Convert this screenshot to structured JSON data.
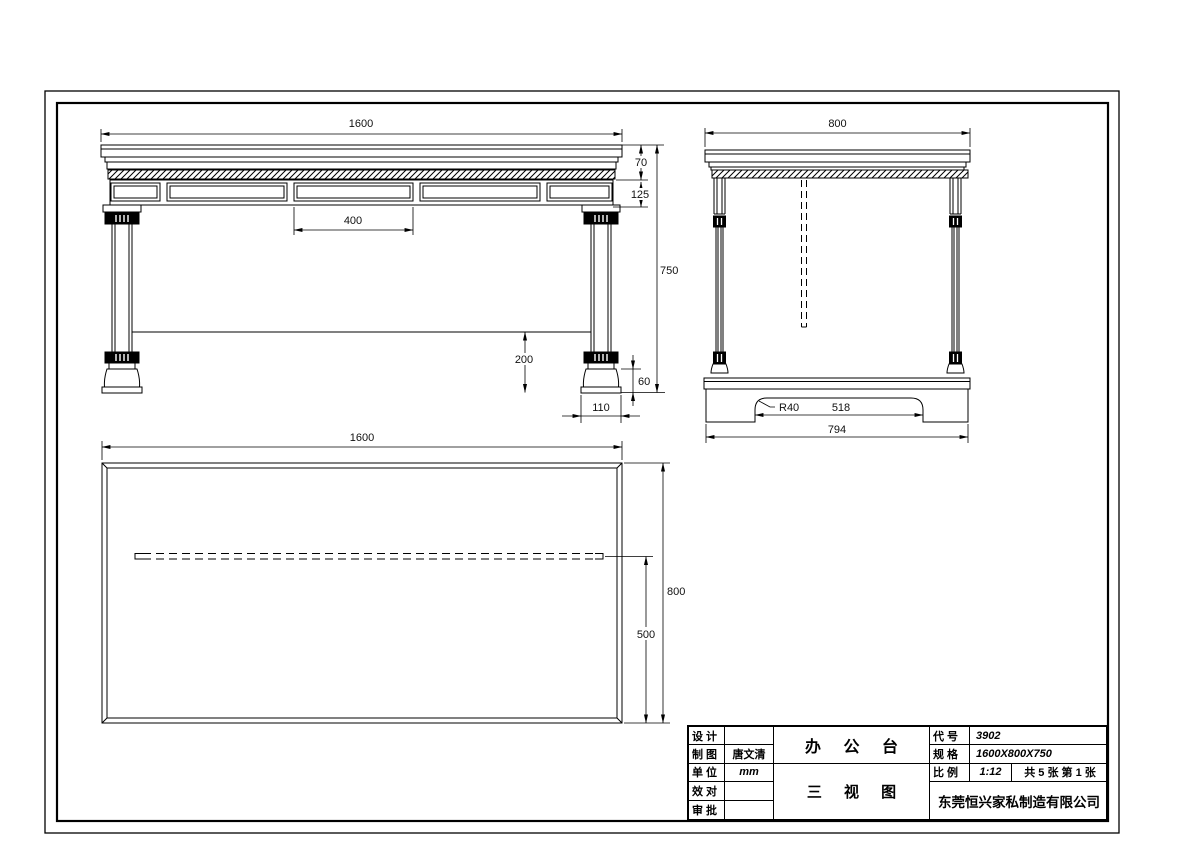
{
  "drawing": {
    "views": {
      "front": {
        "dims": {
          "width": "1600",
          "top_thickness": "70",
          "apron_height": "125",
          "panel_width": "400",
          "overall_height": "750",
          "clearance": "200",
          "foot_height": "60",
          "foot_width": "110"
        }
      },
      "side": {
        "dims": {
          "depth": "800",
          "radius": "R40",
          "cutout_width": "518",
          "base_width": "794"
        }
      },
      "top": {
        "dims": {
          "width": "1600",
          "depth": "800",
          "panel_offset": "500"
        }
      }
    }
  },
  "title_block": {
    "rows_left": [
      {
        "label": "设 计",
        "value": ""
      },
      {
        "label": "制 图",
        "value": "唐文清"
      },
      {
        "label": "单 位",
        "value": "mm"
      },
      {
        "label": "效 对",
        "value": ""
      },
      {
        "label": "审 批",
        "value": ""
      }
    ],
    "product_name": "办 公 台",
    "view_name": "三 视 图",
    "code_label": "代 号",
    "code_value": "3902",
    "spec_label": "规 格",
    "spec_value": "1600X800X750",
    "scale_label": "比 例",
    "scale_value": "1:12",
    "sheet_info": "共 5 张 第 1 张",
    "company": "东莞恒兴家私制造有限公司"
  }
}
